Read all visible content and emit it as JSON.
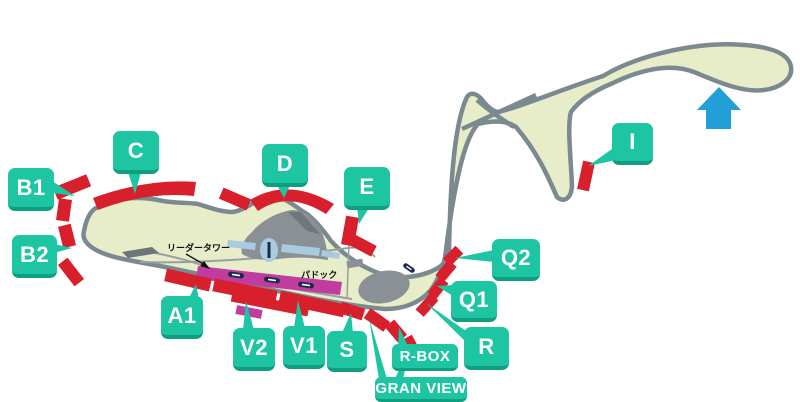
{
  "labels": {
    "b1": "B1",
    "b2": "B2",
    "c": "C",
    "d": "D",
    "e": "E",
    "i": "I",
    "q2": "Q2",
    "q1": "Q1",
    "r": "R",
    "rbox": "R-BOX",
    "granview": "GRAN VIEW",
    "s": "S",
    "v1": "V1",
    "v2": "V2",
    "a1": "A1"
  },
  "annotations": {
    "leader_tower": "リーダータワー",
    "paddock": "パドック"
  },
  "icons": {
    "north_arrow": "up-arrow"
  },
  "colors": {
    "stand_red": "#D7202C",
    "label_teal": "#1EC5A3",
    "label_teal_shadow": "#0E9E80",
    "track_gray": "#7A8A90",
    "infield_green": "#E7ECC9",
    "north_arrow_blue": "#219FD6",
    "pit_magenta": "#C03C9E",
    "building_gray": "#8A9096",
    "facility_blue": "#A9CBE0",
    "marker_navy": "#1B2B4B"
  }
}
